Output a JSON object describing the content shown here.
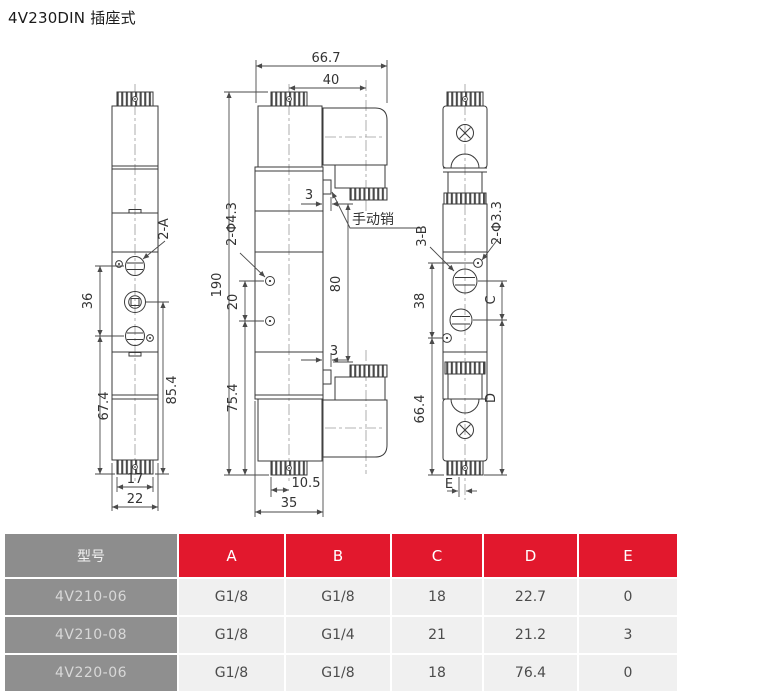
{
  "title": "4V230DIN 插座式",
  "colors": {
    "accent_red": "#e2182d",
    "header_gray": "#8d8d8d",
    "cell_light": "#f0f0f0",
    "line_color": "#3a3a3a"
  },
  "drawing": {
    "left_view": {
      "port_label": "2-A",
      "dim_36": "36",
      "dim_67_4": "67.4",
      "dim_85_4": "85.4",
      "dim_17": "17",
      "dim_22": "22"
    },
    "front_view": {
      "dim_66_7": "66.7",
      "dim_40": "40",
      "dim_190": "190",
      "hole_label": "2-Φ4.3",
      "dim_20": "20",
      "dim_75_4": "75.4",
      "dim_80": "80",
      "dim_3_top": "3",
      "dim_3_bottom": "3",
      "manual_pin_label": "手动销",
      "dim_10_5": "10.5",
      "dim_35": "35"
    },
    "right_view": {
      "port_label": "3-B",
      "hole_label": "2-Φ3.3",
      "dim_38": "38",
      "dim_66_4": "66.4",
      "dim_C": "C",
      "dim_D": "D",
      "dim_E": "E"
    }
  },
  "table": {
    "headers": [
      "型号",
      "A",
      "B",
      "C",
      "D",
      "E"
    ],
    "rows": [
      {
        "model": "4V210-06",
        "values": [
          "G1/8",
          "G1/8",
          "18",
          "22.7",
          "0"
        ]
      },
      {
        "model": "4V210-08",
        "values": [
          "G1/8",
          "G1/4",
          "21",
          "21.2",
          "3"
        ]
      },
      {
        "model": "4V220-06",
        "values": [
          "G1/8",
          "G1/8",
          "18",
          "76.4",
          "0"
        ]
      }
    ]
  }
}
